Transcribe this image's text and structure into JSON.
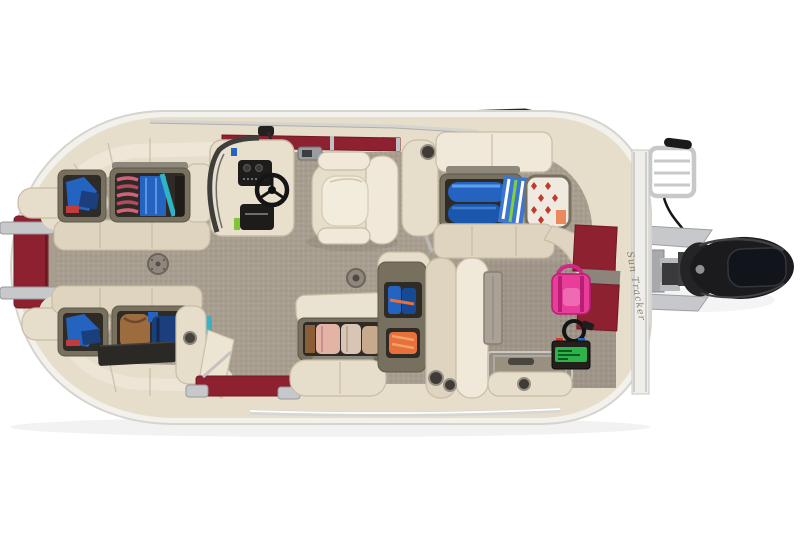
{
  "scene": {
    "alt": "Overhead top-down product photo of a pontoon boat deck layout with open storage compartments, helm console, captain's chair and outboard motor",
    "background": "#ffffff"
  },
  "hull": {
    "logo_text": "Sun Tracker"
  },
  "colors": {
    "background": "#ffffff",
    "hull_rim": "#f2f1ec",
    "hull_rim_edge": "#d6d4cd",
    "upholstery": "#e6decb",
    "upholstery_light": "#f0e9da",
    "upholstery_mid": "#ded4bf",
    "upholstery_shadow": "#c8bda5",
    "deck_floor": "#a89e90",
    "deck_floor_dark": "#95897b",
    "accent_red": "#8e2130",
    "accent_red_dark": "#701a26",
    "bin_frame": "#77705f",
    "bin_interior": "#2e2b26",
    "chrome": "#c7c8ca",
    "chrome_dark": "#97989c",
    "motor_black": "#1b1b1d",
    "motor_window": "#11141b",
    "console_black": "#1d1c1b",
    "gear_blue": "#2563c0",
    "gear_blue_dark": "#1b3f7c",
    "gear_teal": "#2fb3c9",
    "gear_rope_pink": "#d76079",
    "gear_orange": "#e8703a",
    "gear_pink": "#e83e9a",
    "gear_brown": "#9c6b3e",
    "gear_tan": "#c7a98c",
    "battery_green": "#2db34a",
    "stripe_green": "#7fd13f",
    "pattern_red": "#c0392b"
  }
}
